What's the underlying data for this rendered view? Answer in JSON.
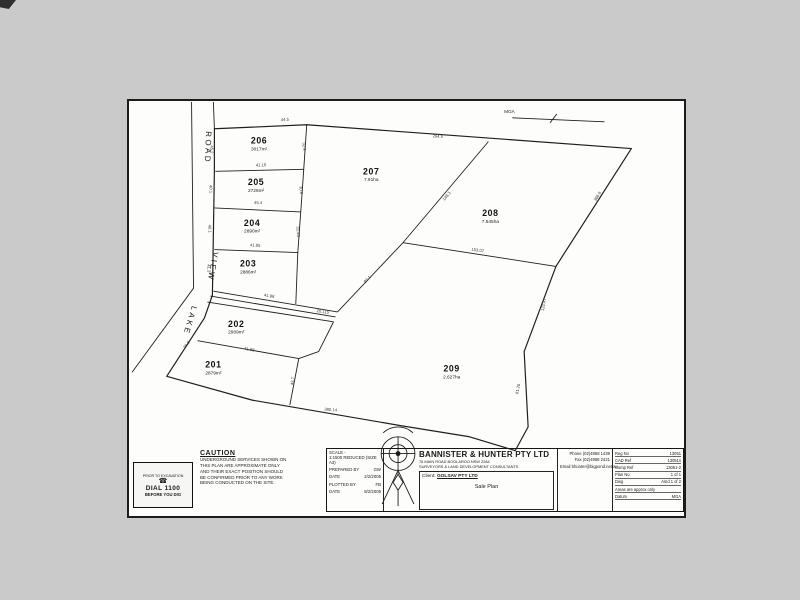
{
  "sheet": {
    "bg": "#fdfdfc",
    "page_bg": "#cacaca",
    "line_color": "#1f1f1f"
  },
  "north": {
    "label": "MGA"
  },
  "road": {
    "labels": [
      {
        "text": "ROAD",
        "x": 204,
        "y": 146,
        "rot": 92
      },
      {
        "text": "VIEW",
        "x": 209,
        "y": 266,
        "rot": 100
      },
      {
        "text": "LAKE",
        "x": 186,
        "y": 320,
        "rot": 107
      }
    ]
  },
  "lots": [
    {
      "num": "201",
      "area": "2879m²",
      "x": 212,
      "y": 368
    },
    {
      "num": "202",
      "area": "2909m²",
      "x": 235,
      "y": 327
    },
    {
      "num": "203",
      "area": "2886m²",
      "x": 247,
      "y": 266
    },
    {
      "num": "204",
      "area": "2890m²",
      "x": 251,
      "y": 225
    },
    {
      "num": "205",
      "area": "2726m²",
      "x": 255,
      "y": 184
    },
    {
      "num": "206",
      "area": "3017m²",
      "x": 258,
      "y": 142
    },
    {
      "num": "207",
      "area": "7.91ha",
      "x": 371,
      "y": 173
    },
    {
      "num": "208",
      "area": "7.545ha",
      "x": 491,
      "y": 215
    },
    {
      "num": "209",
      "area": "2.627ha",
      "x": 452,
      "y": 372
    }
  ],
  "dims": [
    {
      "t": "44.5",
      "x": 284,
      "y": 119,
      "r": -2
    },
    {
      "t": "264.5",
      "x": 438,
      "y": 136,
      "r": 4
    },
    {
      "t": "366.9",
      "x": 600,
      "y": 196,
      "r": -58
    },
    {
      "t": "124.47",
      "x": 546,
      "y": 305,
      "r": -80
    },
    {
      "t": "380.14",
      "x": 330,
      "y": 412,
      "r": 5
    },
    {
      "t": "41.15",
      "x": 260,
      "y": 165,
      "r": -1
    },
    {
      "t": "45.4",
      "x": 257,
      "y": 203,
      "r": 2
    },
    {
      "t": "41.85",
      "x": 254,
      "y": 246,
      "r": 2
    },
    {
      "t": "45.2",
      "x": 209,
      "y": 148,
      "r": 88
    },
    {
      "t": "40.1",
      "x": 208,
      "y": 188,
      "r": 88
    },
    {
      "t": "40.1",
      "x": 207,
      "y": 228,
      "r": 88
    },
    {
      "t": "41.3",
      "x": 206,
      "y": 268,
      "r": 88
    },
    {
      "t": "32.9",
      "x": 302,
      "y": 145,
      "r": 86
    },
    {
      "t": "30.9",
      "x": 299,
      "y": 189,
      "r": 86
    },
    {
      "t": "31.45",
      "x": 296,
      "y": 231,
      "r": 86
    },
    {
      "t": "41.98",
      "x": 268,
      "y": 297,
      "r": 9
    },
    {
      "t": "20.115",
      "x": 322,
      "y": 313,
      "r": 9
    },
    {
      "t": "93.1",
      "x": 368,
      "y": 280,
      "r": -47
    },
    {
      "t": "148.3",
      "x": 448,
      "y": 196,
      "r": -50
    },
    {
      "t": "153.07",
      "x": 478,
      "y": 251,
      "r": 9
    },
    {
      "t": "61.26",
      "x": 520,
      "y": 390,
      "r": -78
    },
    {
      "t": "41.58",
      "x": 248,
      "y": 351,
      "r": 10
    },
    {
      "t": "43.7",
      "x": 293,
      "y": 382,
      "r": -82
    },
    {
      "t": "36.8",
      "x": 186,
      "y": 346,
      "r": -52
    }
  ],
  "caution": {
    "title": "CAUTION",
    "lines": [
      "UNDERGROUND SERVICES SHOWN ON",
      "THIS PLAN ARE APPROXIMATE ONLY",
      "AND THEIR EXACT POSITION SHOULD",
      "BE CONFIRMED PRIOR TO ANY WORK",
      "BEING CONDUCTED ON THE SITE."
    ]
  },
  "dig_logo": {
    "top": "PRIOR TO EXCAVATION",
    "glyph": "☎",
    "main": "DIAL 1100",
    "bottom": "BEFORE YOU DIG"
  },
  "title_block": {
    "scale": {
      "label": "SCALE -",
      "value": "1:1500 REDUCED (SIZE A3)",
      "rows": [
        [
          "PREPARED BY",
          "GW"
        ],
        [
          "DATE",
          "2/2/2005"
        ],
        [
          "PLOTTED BY",
          "FB"
        ],
        [
          "DATE",
          "8/2/2005"
        ]
      ]
    },
    "firm": {
      "name": "BANNISTER & HUNTER PTY LTD",
      "line1": "76 MAIN ROAD BOOLAROO NSW 2284",
      "line2": "SURVEYORS & LAND DEVELOPMENT CONSULTANTS",
      "client_label": "Client:",
      "client": "GOLSAV PTY LTD",
      "doc_title": "Sale Plan"
    },
    "contact": {
      "phone": "Phone (02)4958 1439",
      "fax": "Fax (02)4958 2421",
      "email": "Email bhunter@bigpond.net.au"
    },
    "refs": [
      [
        "Reg No",
        "13051"
      ],
      [
        "CAD Ref",
        "13051s"
      ],
      [
        "Comp Ref",
        "13051-2"
      ],
      [
        "Plan No",
        "1 of 1"
      ],
      [
        "Dwg",
        "Amd 1 of 2"
      ],
      [
        "Areas are approx only",
        ""
      ],
      [
        "Datum",
        "MGA"
      ]
    ]
  }
}
